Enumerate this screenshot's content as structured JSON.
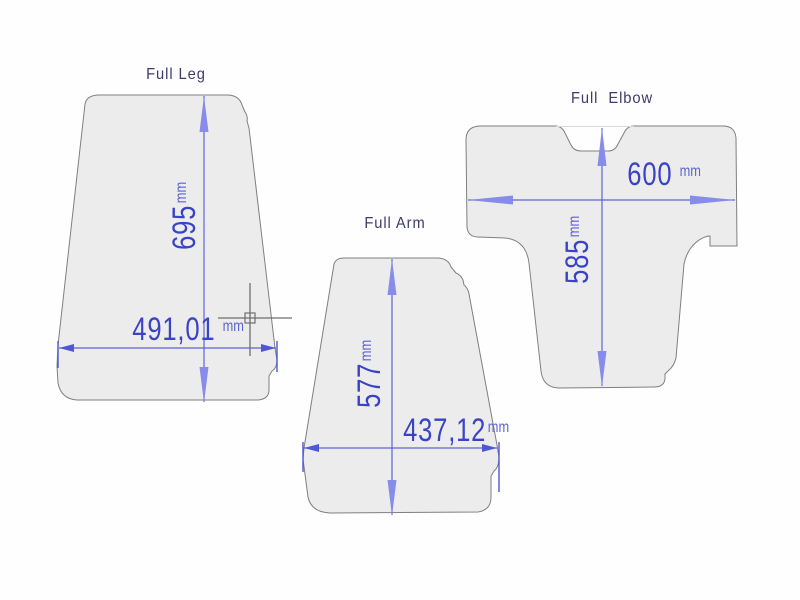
{
  "drawing": {
    "type": "cad-pattern-drawing",
    "pieces": [
      {
        "id": "full-leg",
        "title": "Full Leg",
        "height_value": "695",
        "height_unit": "mm",
        "width_value": "491,01",
        "width_unit": "mm"
      },
      {
        "id": "full-arm",
        "title": "Full Arm",
        "height_value": "577",
        "height_unit": "mm",
        "width_value": "437,12",
        "width_unit": "mm"
      },
      {
        "id": "full-elbow",
        "title": "Full  Elbow",
        "width_value": "600",
        "width_unit": "mm",
        "height_value": "585",
        "height_unit": "mm"
      }
    ],
    "colors": {
      "background": "#fefefe",
      "piece_fill": "#ececec",
      "piece_outline": "#7f7f7f",
      "dimension_line": "#5c63d6",
      "dimension_text": "#3a43c6",
      "arrow_fill": "#878bea",
      "title_text": "#3c3c6a",
      "cursor": "#6e6e6e"
    },
    "cursor": {
      "name": "crosshair-cursor"
    }
  }
}
